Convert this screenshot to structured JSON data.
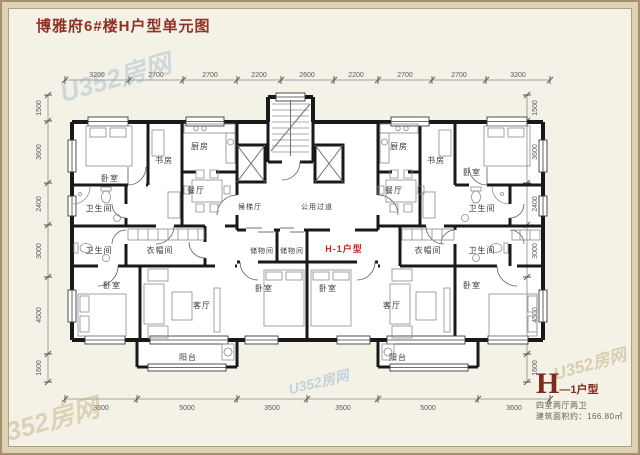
{
  "title": "博雅府6#楼H户型单元图",
  "watermark": "U352房网",
  "unit_tag": "H-1户型",
  "info": {
    "type_letter": "H",
    "type_suffix": "—1户型",
    "layout": "四室两厅两卫",
    "area": "建筑面积约：166.80㎡"
  },
  "dims": {
    "top": [
      "3200",
      "2700",
      "2700",
      "2200",
      "2600",
      "2200",
      "2700",
      "2700",
      "3200"
    ],
    "bottom": [
      "3600",
      "5000",
      "3500",
      "3500",
      "5000",
      "3600"
    ],
    "left": [
      "1500",
      "3600",
      "2400",
      "3000",
      "4500",
      "1600"
    ],
    "right": [
      "1500",
      "3600",
      "2400",
      "3000",
      "4500",
      "1600"
    ]
  },
  "rooms": [
    {
      "name": "bedroom-top-left",
      "label": "卧室"
    },
    {
      "name": "study-left",
      "label": "书房"
    },
    {
      "name": "kitchen-left",
      "label": "厨房"
    },
    {
      "name": "dining-left",
      "label": "餐厅"
    },
    {
      "name": "bath-left-upper",
      "label": "卫生间"
    },
    {
      "name": "bath-left-lower",
      "label": "卫生间"
    },
    {
      "name": "cloakroom-left",
      "label": "衣帽间"
    },
    {
      "name": "bedroom-mid-left",
      "label": "卧室"
    },
    {
      "name": "living-left",
      "label": "客厅"
    },
    {
      "name": "balcony-left",
      "label": "阳台"
    },
    {
      "name": "elevator-lobby",
      "label": "候梯厅"
    },
    {
      "name": "public-corridor",
      "label": "公用过道"
    },
    {
      "name": "storage-left",
      "label": "储物间"
    },
    {
      "name": "storage-right",
      "label": "储物间"
    },
    {
      "name": "bedroom-center-left",
      "label": "卧室"
    },
    {
      "name": "bedroom-center-right",
      "label": "卧室"
    },
    {
      "name": "kitchen-right",
      "label": "厨房"
    },
    {
      "name": "study-right",
      "label": "书房"
    },
    {
      "name": "bedroom-top-right",
      "label": "卧室"
    },
    {
      "name": "dining-right",
      "label": "餐厅"
    },
    {
      "name": "bath-right-upper",
      "label": "卫生间"
    },
    {
      "name": "cloakroom-right",
      "label": "衣帽间"
    },
    {
      "name": "bath-right-lower",
      "label": "卫生间"
    },
    {
      "name": "bedroom-mid-right",
      "label": "卧室"
    },
    {
      "name": "living-right",
      "label": "客厅"
    },
    {
      "name": "balcony-right",
      "label": "阳台"
    }
  ]
}
